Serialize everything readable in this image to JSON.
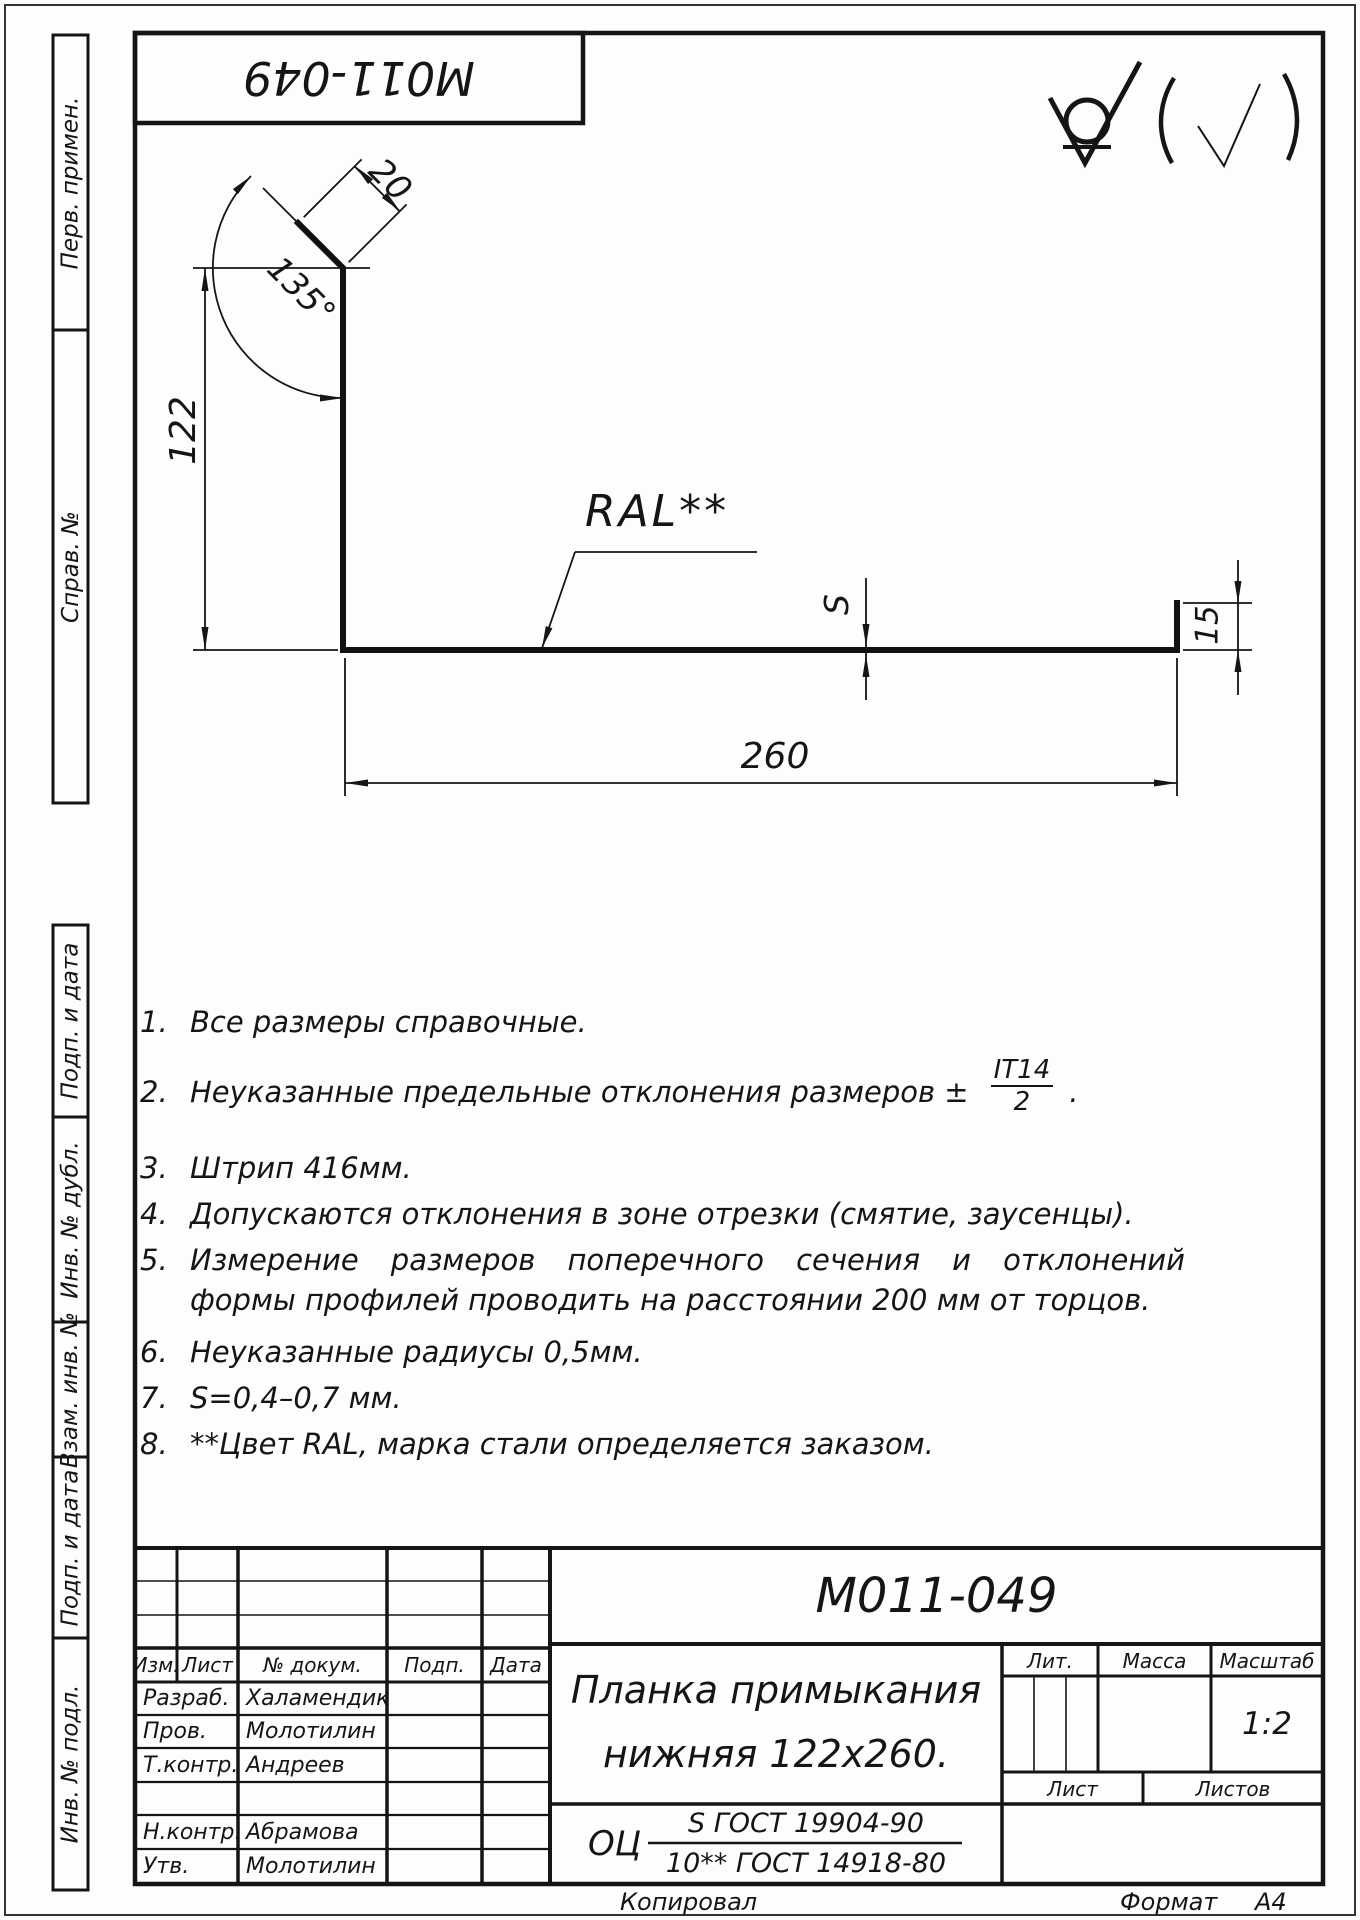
{
  "stamp_top": {
    "doc_number": "M011-049"
  },
  "roughness": {
    "symbol": "check-in-circle",
    "suffix": "(√)"
  },
  "drawing": {
    "dims": {
      "d122": "122",
      "d260": "260",
      "d20": "20",
      "angle": "135°",
      "d15": "15",
      "s": "S"
    },
    "coating_label": "RAL**"
  },
  "notes": [
    {
      "num": "1.",
      "text": "Все размеры справочные."
    },
    {
      "num": "2.",
      "text": "Неуказанные предельные отклонения размеров ±",
      "frac_num": "IT14",
      "frac_den": "2",
      "tail": "."
    },
    {
      "num": "3.",
      "text": "Штрип  416мм."
    },
    {
      "num": "4.",
      "text": "Допускаются отклонения в зоне отрезки (смятие, заусенцы)."
    },
    {
      "num": "5.",
      "text": "Измерение размеров поперечного сечения и отклонений формы профилей проводить на расстоянии 200 мм от торцов."
    },
    {
      "num": "6.",
      "text": "Неуказанные радиусы 0,5мм."
    },
    {
      "num": "7.",
      "text": "S=0,4–0,7 мм."
    },
    {
      "num": "8.",
      "text": "**Цвет RAL, марка стали определяется заказом."
    }
  ],
  "side_labels": [
    "Перв. примен.",
    "Справ. №",
    "Подп. и дата",
    "Инв. № дубл.",
    "Взам. инв. №",
    "Подп. и дата",
    "Инв. № подл."
  ],
  "title_block": {
    "doc_number": "M011-049",
    "title_line1": "Планка примыкания",
    "title_line2": "нижняя 122x260.",
    "material_prefix": "ОЦ",
    "material_num": "S ГОСТ 19904-90",
    "material_den": "10** ГОСТ 14918-80",
    "scale_value": "1:2",
    "headers": {
      "izm": "Изм.",
      "list": "Лист",
      "doc": "№ докум.",
      "sign": "Подп.",
      "date": "Дата",
      "lit": "Лит.",
      "mass": "Масса",
      "scale": "Масштаб",
      "sheet": "Лист",
      "sheets": "Листов"
    },
    "rows": [
      {
        "role": "Разраб.",
        "name": "Халамендик"
      },
      {
        "role": "Пров.",
        "name": "Молотилин"
      },
      {
        "role": "Т.контр.",
        "name": "Андреев"
      },
      {
        "role": "",
        "name": ""
      },
      {
        "role": "Н.контр.",
        "name": "Абрамова"
      },
      {
        "role": "Утв.",
        "name": "Молотилин"
      }
    ],
    "footer": {
      "kopiroval": "Копировал",
      "format": "Формат",
      "format_value": "A4"
    }
  }
}
